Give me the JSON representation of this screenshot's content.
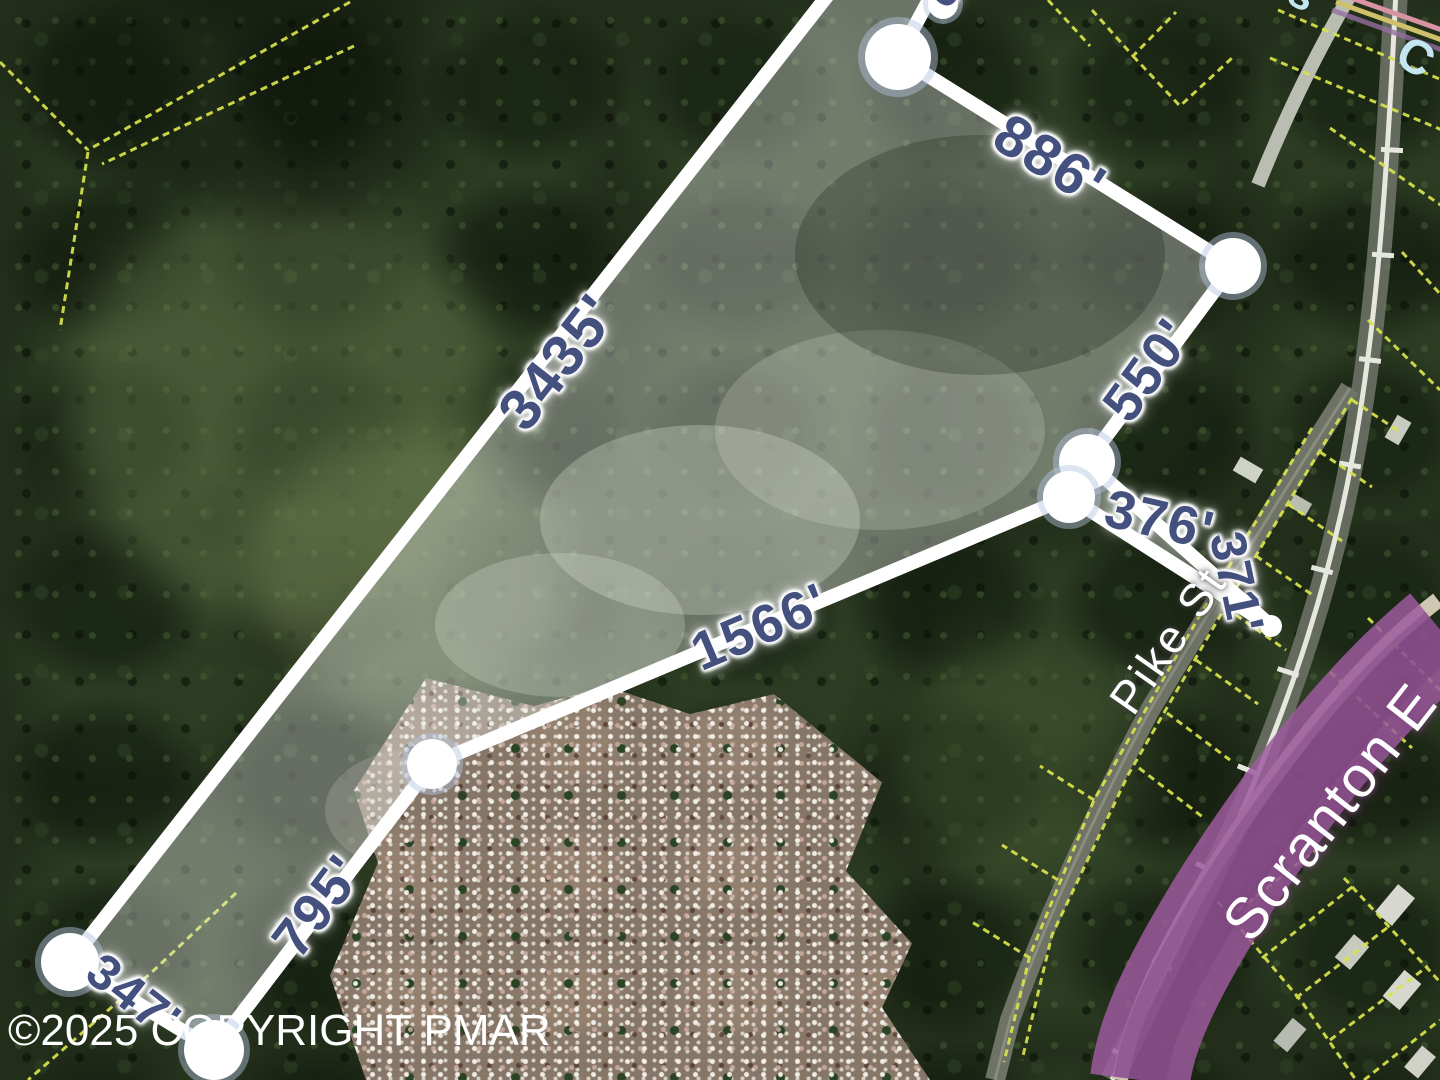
{
  "map": {
    "copyright": "©2025 COPYRIGHT PMAR",
    "measurements": {
      "west": "3435'",
      "north": "886'",
      "northeast": "550'",
      "east_upper": "376'",
      "east_lower": "371'",
      "south": "1566'",
      "southwest": "795'",
      "south_end": "347'",
      "top_clipped": "5"
    },
    "streets": {
      "pike": "Pike St",
      "expressway": "Scranton E",
      "top_right_fragment_a": "s",
      "top_right_fragment_b": "C"
    },
    "colors": {
      "measurement_text": "#44507E",
      "measurement_halo": "#FFFFFF",
      "boundary_line": "#FFFFFF",
      "parcel_line": "#D9E34B",
      "highway_overlay": "#9C5A9E",
      "street_label": "#FFFFFF",
      "road_label_fragment": "#C4E7EF",
      "copyright_text": "#FFFFFF"
    }
  }
}
